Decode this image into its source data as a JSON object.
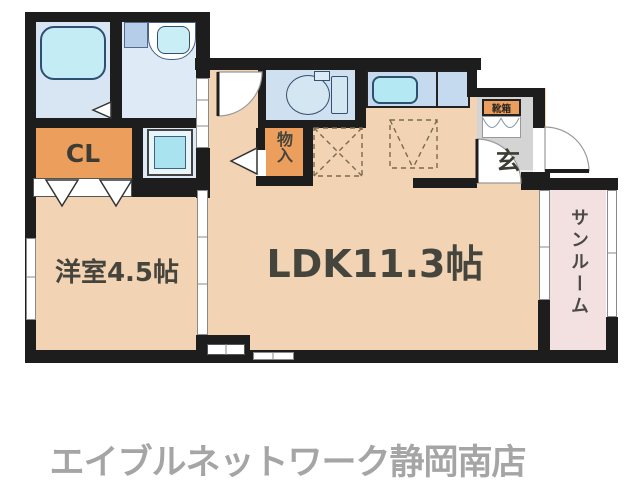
{
  "floorplan": {
    "rooms": {
      "ldk": {
        "label": "LDK11.3帖"
      },
      "western": {
        "label": "洋室4.5帖"
      },
      "closet": {
        "label": "CL"
      },
      "storage": {
        "label": "物入"
      },
      "genkan": {
        "label": "玄"
      },
      "shoebox": {
        "label": "靴箱"
      },
      "sunroom": {
        "label": "サンルーム"
      }
    },
    "colors": {
      "wall": "#1d1d1d",
      "floor_main": "#f2d3b4",
      "closet_orange": "#ec9e5d",
      "bath_blue": "#d8e6f4",
      "washroom_blue": "#dfeaf7",
      "toilet_blue": "#cfe1f1",
      "kitchen_blue": "#c6daef",
      "fixture_cyan": "#b6e9f3",
      "genkan_gray": "#d4d4d4",
      "sunroom_pink": "#f3e1e1",
      "label_dark": "#45453d",
      "footer_gray": "#a5a5a5"
    }
  },
  "footer": {
    "store_name": "エイブルネットワーク静岡南店"
  }
}
